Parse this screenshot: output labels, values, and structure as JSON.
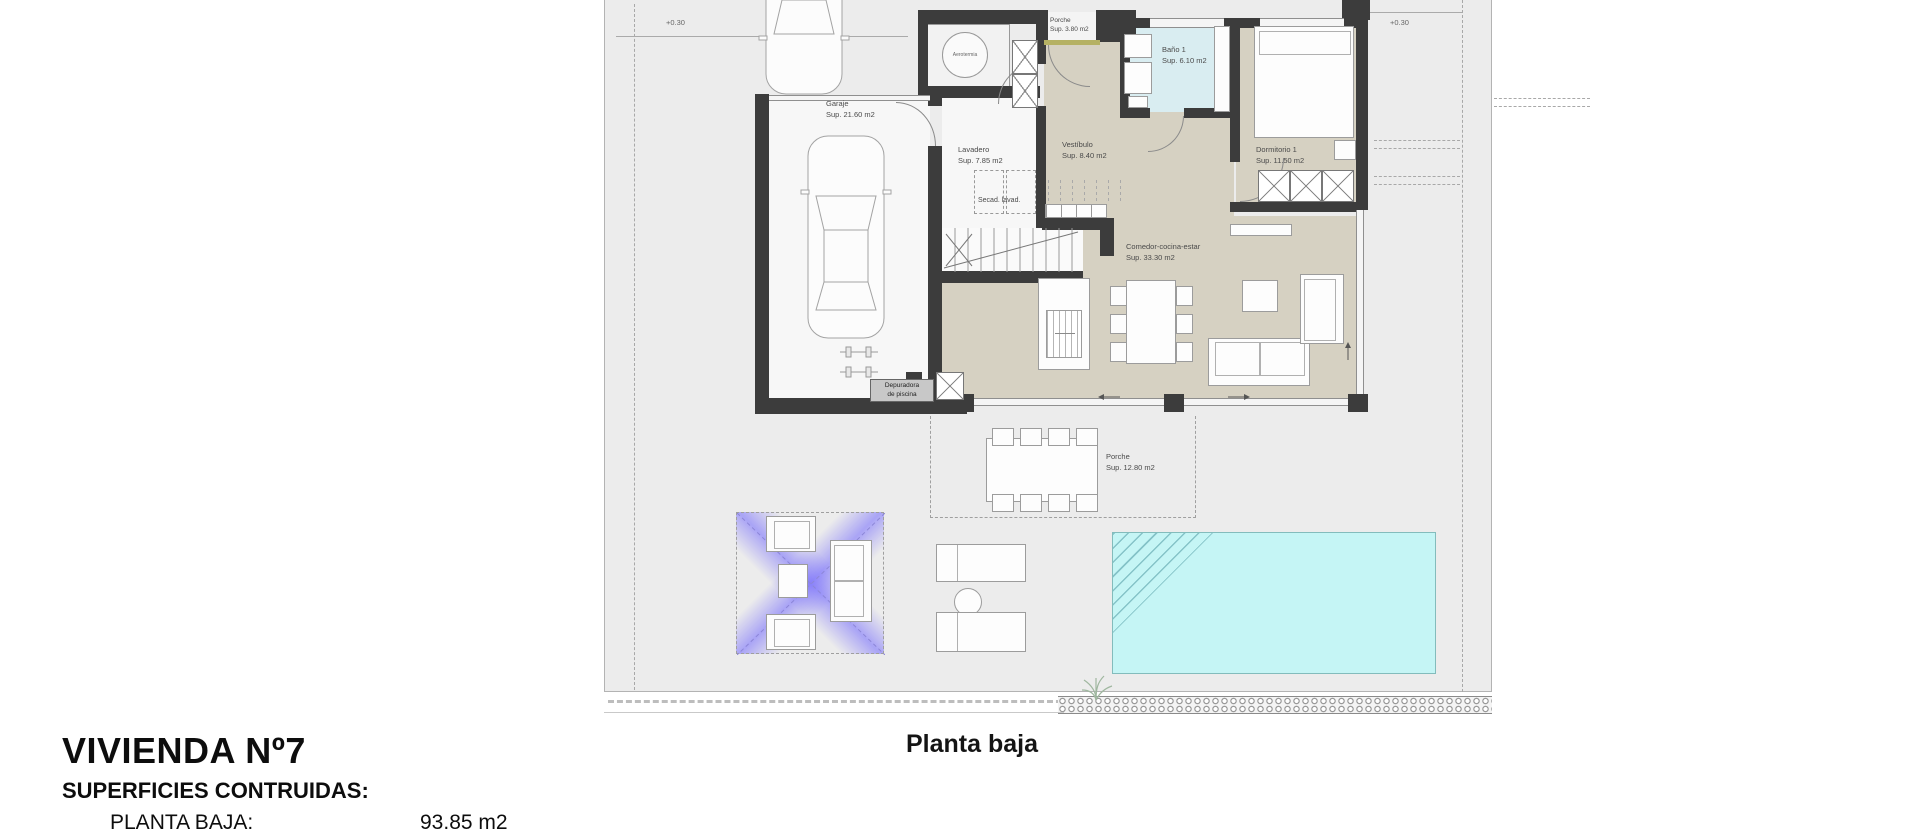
{
  "plan_caption": "Planta baja",
  "title_block": {
    "title": "VIVIENDA Nº7",
    "subtitle": "SUPERFICIES CONTRUIDAS:",
    "row_label": "PLANTA BAJA:",
    "row_value": "93.85 m2"
  },
  "levels": {
    "driveway": "+0.30",
    "garage_court": "+0.30",
    "terrace": "+0.30"
  },
  "rooms": {
    "porche_top": {
      "name": "Porche",
      "area": "Sup. 3.80 m2"
    },
    "bano1": {
      "name": "Baño 1",
      "area": "Sup. 6.10 m2"
    },
    "dormitorio1": {
      "name": "Dormitorio 1",
      "area": "Sup. 11.50 m2"
    },
    "vestibulo": {
      "name": "Vestíbulo",
      "area": "Sup. 8.40 m2"
    },
    "lavadero": {
      "name": "Lavadero",
      "area": "Sup. 7.85 m2"
    },
    "garaje": {
      "name": "Garaje",
      "area": "Sup. 21.60 m2"
    },
    "comedor": {
      "name": "Comedor-cocina-estar",
      "area": "Sup. 33.30 m2"
    },
    "porche_bajo": {
      "name": "Porche",
      "area": "Sup. 12.80 m2"
    }
  },
  "equipment": {
    "aerotermia": "Aerotermia",
    "laundry": "Secad. lavad.",
    "depuradora_line1": "Depuradora",
    "depuradora_line2": "de piscina"
  },
  "colors": {
    "wall": "#3c3c3c",
    "floor_beige": "#d6d1c2",
    "bath_blue": "#d9edf1",
    "pool_cyan": "#c5f5f5",
    "plot_gray": "#ececec",
    "pergola_purple": "#675cff",
    "threshold_khaki": "#b5b163"
  }
}
